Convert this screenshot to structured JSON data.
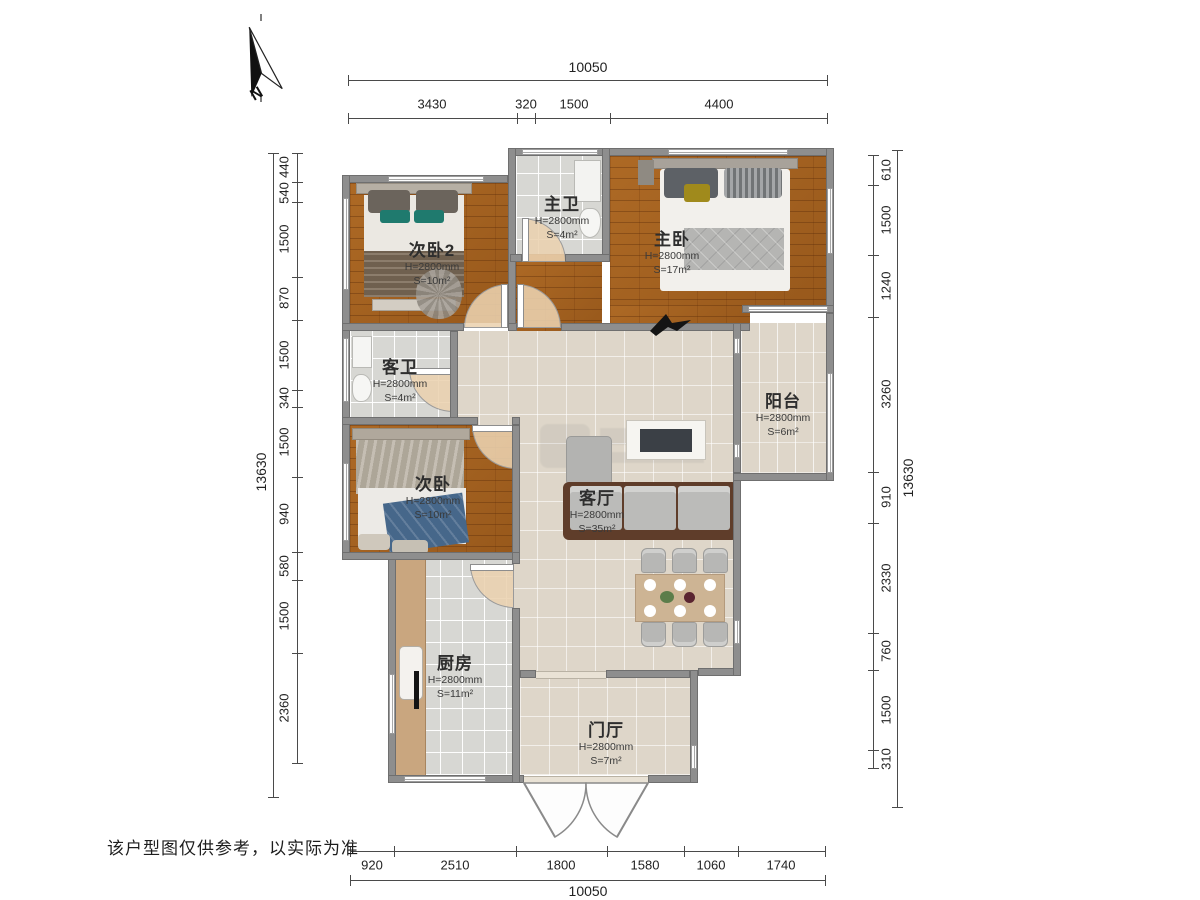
{
  "meta": {
    "disclaimer": "该户型图仅供参考，以实际为准",
    "compass_label": "N"
  },
  "rooms": [
    {
      "id": "bedroom2",
      "name": "次卧2",
      "height": "H=2800mm",
      "area": "S=10m²"
    },
    {
      "id": "master-bath",
      "name": "主卫",
      "height": "H=2800mm",
      "area": "S=4m²"
    },
    {
      "id": "master-bedroom",
      "name": "主卧",
      "height": "H=2800mm",
      "area": "S=17m²"
    },
    {
      "id": "guest-bath",
      "name": "客卫",
      "height": "H=2800mm",
      "area": "S=4m²"
    },
    {
      "id": "bedroom",
      "name": "次卧",
      "height": "H=2800mm",
      "area": "S=10m²"
    },
    {
      "id": "balcony",
      "name": "阳台",
      "height": "H=2800mm",
      "area": "S=6m²"
    },
    {
      "id": "living-room",
      "name": "客厅",
      "height": "H=2800mm",
      "area": "S=35m²"
    },
    {
      "id": "kitchen",
      "name": "厨房",
      "height": "H=2800mm",
      "area": "S=11m²"
    },
    {
      "id": "foyer",
      "name": "门厅",
      "height": "H=2800mm",
      "area": "S=7m²"
    }
  ],
  "dimensions": {
    "top": {
      "total": "10050",
      "segments": [
        "3430",
        "320",
        "1500",
        "4400"
      ]
    },
    "bottom": {
      "total": "10050",
      "segments": [
        "920",
        "2510",
        "1800",
        "1580",
        "1060",
        "1740"
      ]
    },
    "left": {
      "total": "13630",
      "segments": [
        "440",
        "540",
        "1500",
        "870",
        "1500",
        "340",
        "1500",
        "940",
        "580",
        "1500",
        "2360"
      ]
    },
    "right": {
      "total": "13630",
      "segments": [
        "610",
        "1500",
        "1240",
        "3260",
        "910",
        "2330",
        "760",
        "1500",
        "310"
      ]
    }
  }
}
